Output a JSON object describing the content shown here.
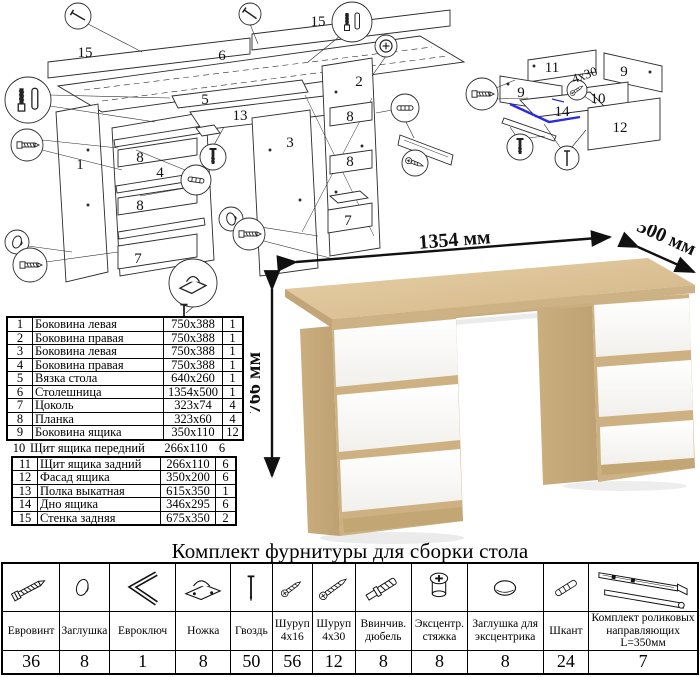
{
  "product": {
    "dimensions": {
      "width": "1354 мм",
      "depth": "500 мм",
      "height": "766 мм"
    }
  },
  "diagrams": {
    "main": {
      "labels": {
        "back_panel_a": "15",
        "back_panel_b": "15",
        "desktop": "6",
        "left_side": "1",
        "inner_right_side": "4",
        "center_panel": "3",
        "right_side": "2",
        "tie": "5",
        "shelf": "13",
        "plank_a": "8",
        "plank_b": "8",
        "plank_c": "8",
        "plank_d": "8",
        "plinth_a": "7",
        "plinth_b": "7"
      }
    },
    "drawer": {
      "labels": {
        "back": "11",
        "side_a": "9",
        "side_b": "9",
        "front": "10",
        "bottom": "14",
        "facade": "12"
      },
      "screw_note": "4x30"
    }
  },
  "parts_table": {
    "rows": [
      {
        "num": "1",
        "name": "Боковина левая",
        "size": "750x388",
        "qty": "1"
      },
      {
        "num": "2",
        "name": "Боковина правая",
        "size": "750x388",
        "qty": "1"
      },
      {
        "num": "3",
        "name": "Боковина левая",
        "size": "750x388",
        "qty": "1"
      },
      {
        "num": "4",
        "name": "Боковина правая",
        "size": "750x388",
        "qty": "1"
      },
      {
        "num": "5",
        "name": "Вязка стола",
        "size": "640x260",
        "qty": "1"
      },
      {
        "num": "6",
        "name": "Столешница",
        "size": "1354x500",
        "qty": "1"
      },
      {
        "num": "7",
        "name": "Цоколь",
        "size": "323x74",
        "qty": "4"
      },
      {
        "num": "8",
        "name": "Планка",
        "size": "323x60",
        "qty": "4"
      },
      {
        "num": "9",
        "name": "Боковина ящика",
        "size": "350x110",
        "qty": "12"
      },
      {
        "num": "10",
        "name": "Щит ящика передний",
        "size": "266x110",
        "qty": "6"
      },
      {
        "num": "11",
        "name": "Щит ящика задний",
        "size": "266x110",
        "qty": "6"
      },
      {
        "num": "12",
        "name": "Фасад ящика",
        "size": "350x200",
        "qty": "6"
      },
      {
        "num": "13",
        "name": "Полка выкатная",
        "size": "615x350",
        "qty": "1"
      },
      {
        "num": "14",
        "name": "Дно ящика",
        "size": "346x295",
        "qty": "6"
      },
      {
        "num": "15",
        "name": "Стенка задняя",
        "size": "675x350",
        "qty": "2"
      }
    ]
  },
  "hardware": {
    "title": "Комплект фурнитуры для сборки стола",
    "items": [
      {
        "name": "Евровинт",
        "qty": "36"
      },
      {
        "name": "Заглушка",
        "qty": "8"
      },
      {
        "name": "Евроключ",
        "qty": "1"
      },
      {
        "name": "Ножка",
        "qty": "8"
      },
      {
        "name": "Гвоздь",
        "qty": "50"
      },
      {
        "name": "Шуруп 4х16",
        "qty": "56"
      },
      {
        "name": "Шуруп 4х30",
        "qty": "12"
      },
      {
        "name": "Ввинчив. дюбель",
        "qty": "8"
      },
      {
        "name": "Эксцентр. стяжка",
        "qty": "8"
      },
      {
        "name": "Заглушка для эксцентрика",
        "qty": "8"
      },
      {
        "name": "Шкант",
        "qty": "24"
      },
      {
        "name": "Комплект роликовых направляющих L=350мм",
        "qty": "7"
      }
    ]
  }
}
